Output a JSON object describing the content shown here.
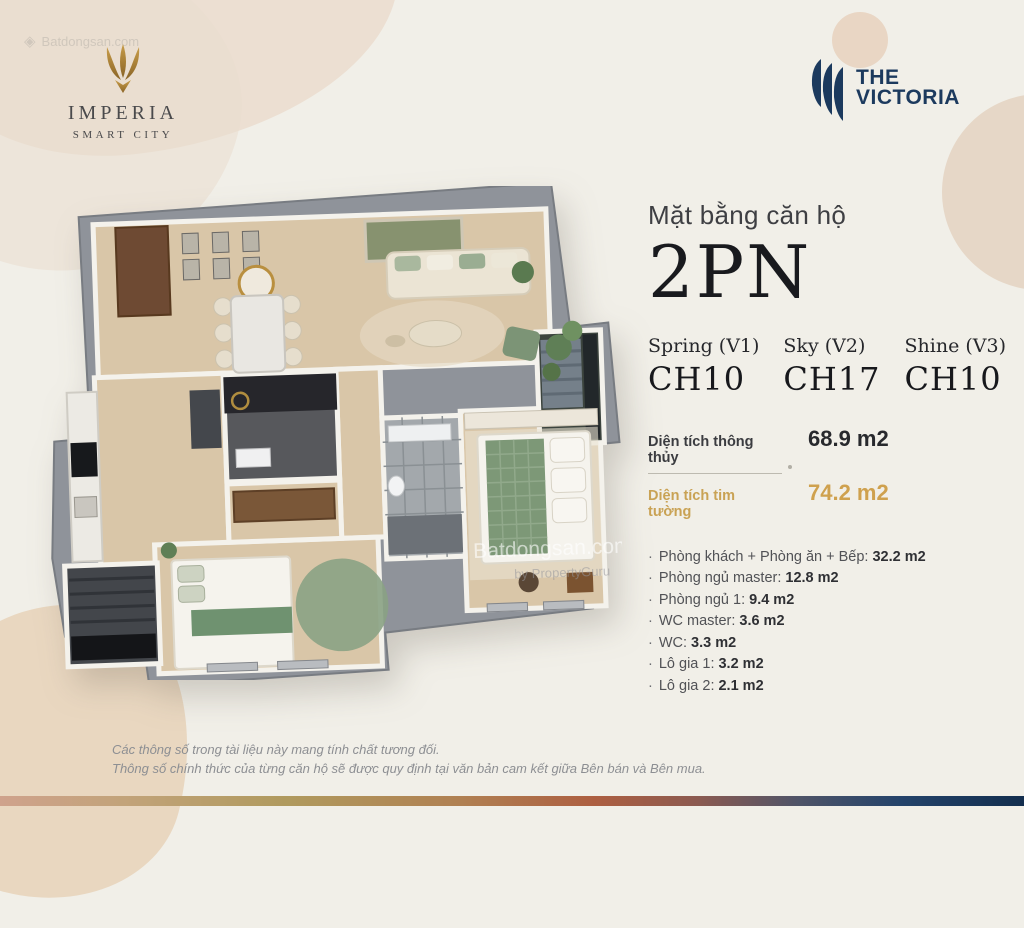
{
  "watermark": {
    "site": "Batdongsan.com",
    "by": "by PropertyGuru",
    "diamond_icon": "◈"
  },
  "brand": {
    "imperia": {
      "name": "IMPERIA",
      "subtitle": "SMART CITY",
      "gold": "#b08a3e"
    },
    "victoria": {
      "line1": "THE",
      "line2": "VICTORIA",
      "navy": "#1c3a5e"
    }
  },
  "panel": {
    "subtitle": "Mặt bằng căn hộ",
    "unit_type": "2PN",
    "towers": [
      {
        "name": "Spring (V1)",
        "unit": "CH10"
      },
      {
        "name": "Sky (V2)",
        "unit": "CH17"
      },
      {
        "name": "Shine (V3)",
        "unit": "CH10"
      }
    ],
    "areas": [
      {
        "label": "Diện tích thông thủy",
        "value": "68.9 m2"
      },
      {
        "label": "Diện tích tim tường",
        "value": "74.2 m2"
      }
    ],
    "bullet": "·",
    "rooms": [
      {
        "label": "Phòng khách + Phòng ăn + Bếp:",
        "value": "32.2 m2"
      },
      {
        "label": "Phòng ngủ master:",
        "value": "12.8 m2"
      },
      {
        "label": "Phòng ngủ 1:",
        "value": "9.4 m2"
      },
      {
        "label": "WC master:",
        "value": "3.6 m2"
      },
      {
        "label": "WC:",
        "value": "3.3 m2"
      },
      {
        "label": "Lô gia 1:",
        "value": "3.2 m2"
      },
      {
        "label": "Lô gia 2:",
        "value": "2.1 m2"
      }
    ]
  },
  "disclaimer": {
    "line1": "Các thông số trong tài liệu này mang tính chất tương đối.",
    "line2": "Thông số chính thức của từng căn hộ sẽ được quy định tại văn bản cam kết giữa Bên bán và Bên mua."
  },
  "colors": {
    "background": "#f1efe8",
    "blob_beige": "#e9d7c0",
    "gold_accent": "#cfa14e",
    "navy": "#1c3a5e",
    "sage_green": "#7d9877",
    "wood_floor": "#d9c6a8"
  }
}
